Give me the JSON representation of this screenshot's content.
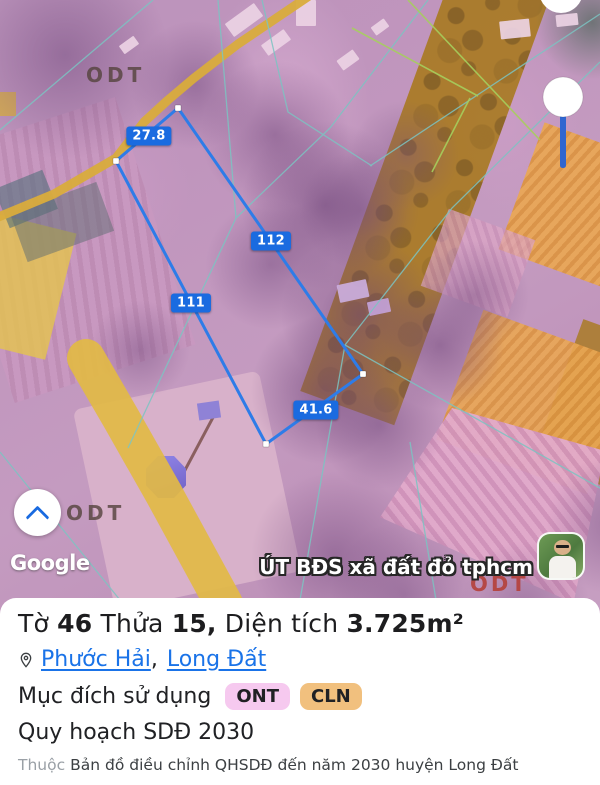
{
  "map": {
    "zone_labels": {
      "odt_top": "ODT",
      "odt_pond": "ODT",
      "odt_red": "ODT"
    },
    "measurements": [
      {
        "value": "27.8"
      },
      {
        "value": "112"
      },
      {
        "value": "111"
      },
      {
        "value": "41.6"
      }
    ],
    "attribution": "Google",
    "watermark": "ÚT BĐS xã đất đỏ tphcm",
    "colors": {
      "parcel_outline": "#2e7ce8",
      "measure_label_bg": "#1a6be0",
      "road_yellow": "#d9ac3c",
      "zone_gold": "#e2ba45",
      "zone_ochre": "#a8791c",
      "zone_orange": "#e8a753",
      "cadastral_line": "#7cc4c2",
      "planning_overlay_pink": "#c28cbd"
    }
  },
  "controls": {
    "collapse": {
      "icon": "chevron-up"
    }
  },
  "panel": {
    "title": {
      "sheet_label": "Tờ",
      "sheet": "46",
      "parcel_label": "Thửa",
      "parcel": "15,",
      "area_label": "Diện tích",
      "area": "3.725m²"
    },
    "location": {
      "ward": "Phước Hải",
      "separator": ",",
      "district": "Long Đất"
    },
    "land_use": {
      "label": "Mục đích sử dụng",
      "badges": [
        {
          "code": "ONT",
          "bg": "#f6c9ef"
        },
        {
          "code": "CLN",
          "bg": "#f1c07e"
        }
      ]
    },
    "planning": "Quy hoạch SDĐ 2030",
    "source": {
      "prefix": "Thuộc",
      "text": "Bản đồ điều chỉnh QHSDĐ đến năm 2030 huyện Long Đất"
    }
  }
}
